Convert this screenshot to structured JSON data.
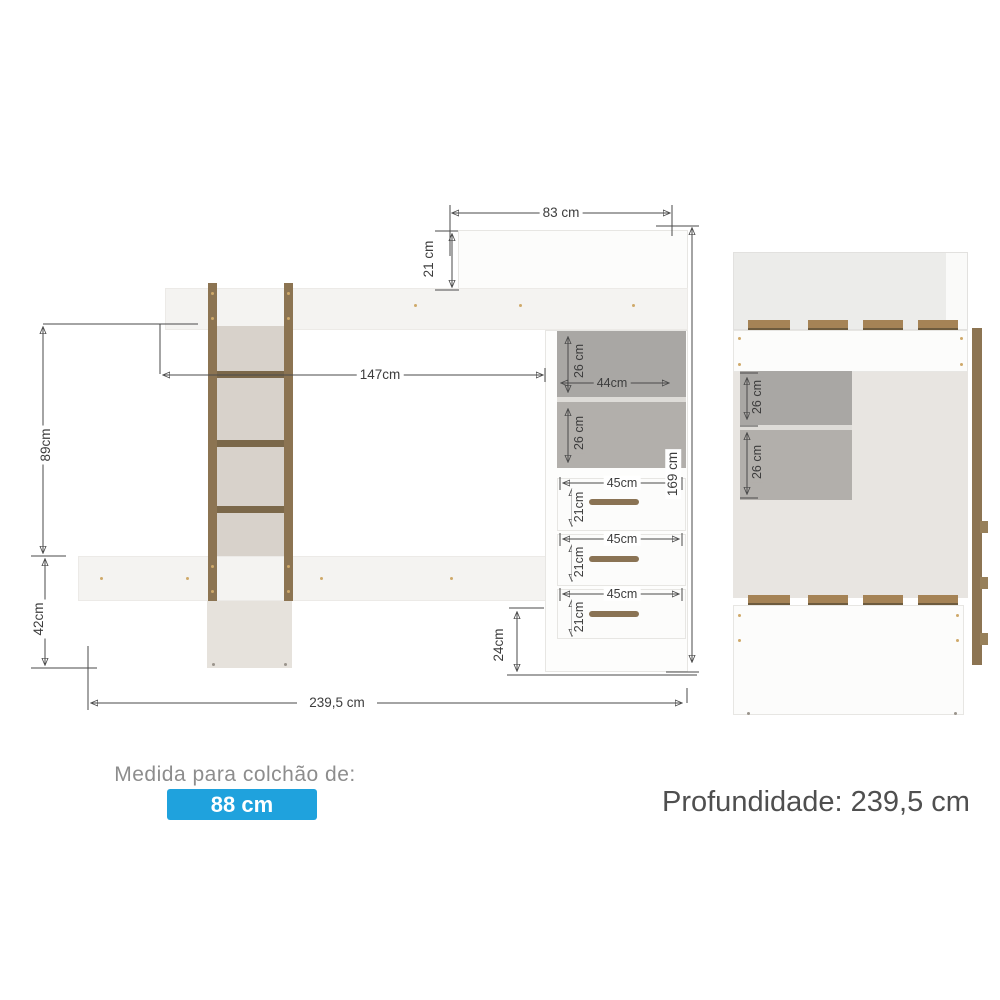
{
  "front_view": {
    "dimensions": {
      "top_width": "83 cm",
      "headboard_height": "21 cm",
      "ladder_to_desk": "147cm",
      "upper_gap_height": "89cm",
      "lower_gap_height": "42cm",
      "total_width": "239,5 cm",
      "total_height": "169 cm",
      "niche_top_height": "26 cm",
      "niche_width": "44cm",
      "niche_bottom_height": "26 cm",
      "base_height": "24cm"
    },
    "drawers": [
      {
        "width": "45cm",
        "height": "21cm"
      },
      {
        "width": "45cm",
        "height": "21cm"
      },
      {
        "width": "45cm",
        "height": "21cm"
      }
    ]
  },
  "side_view": {
    "dimensions": {
      "niche_top_height": "26 cm",
      "niche_bottom_height": "26 cm"
    }
  },
  "footer": {
    "mattress_caption": "Medida para colchão de:",
    "mattress_size": "88 cm",
    "depth": "Profundidade: 239,5 cm"
  },
  "colors": {
    "accent_blue": "#1fa2dd",
    "wood": "#8c7452",
    "niche_gray": "#aeaca8",
    "dimension_ink": "#4a4a4a"
  }
}
